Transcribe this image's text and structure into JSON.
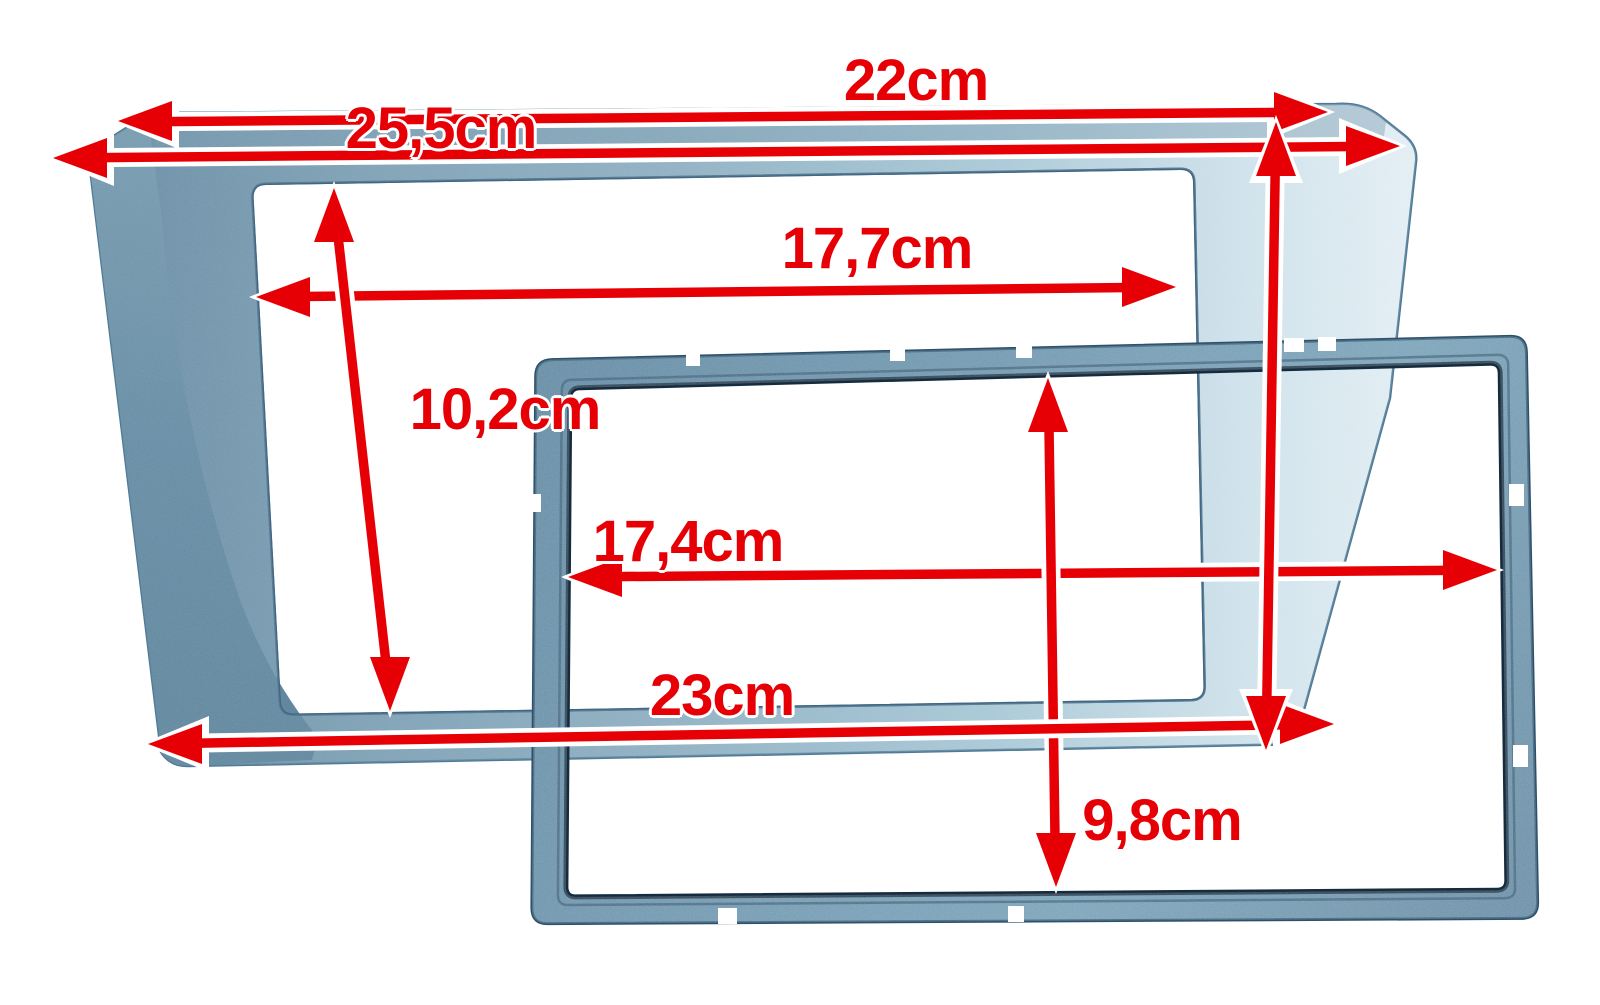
{
  "image": {
    "background_color": "#ffffff",
    "annotation_color": "#e60005",
    "back_frame_color": "#7fa6bc",
    "front_frame_color": "#5d8aa6"
  },
  "frames": {
    "back_frame": {
      "top_width": "22cm",
      "overall_width": "25,5cm",
      "opening_width": "17,7cm",
      "opening_height": "10,2cm",
      "bottom_width": "23cm"
    },
    "front_frame": {
      "opening_width": "17,4cm",
      "opening_height": "9,8cm"
    }
  },
  "dimensions": [
    {
      "id": "back-top-width",
      "label": "22cm"
    },
    {
      "id": "back-overall-width",
      "label": "25,5cm"
    },
    {
      "id": "back-opening-width",
      "label": "17,7cm"
    },
    {
      "id": "back-opening-height",
      "label": "10,2cm"
    },
    {
      "id": "front-opening-width",
      "label": "17,4cm"
    },
    {
      "id": "back-bottom-width",
      "label": "23cm"
    },
    {
      "id": "front-opening-height",
      "label": "9,8cm"
    }
  ]
}
